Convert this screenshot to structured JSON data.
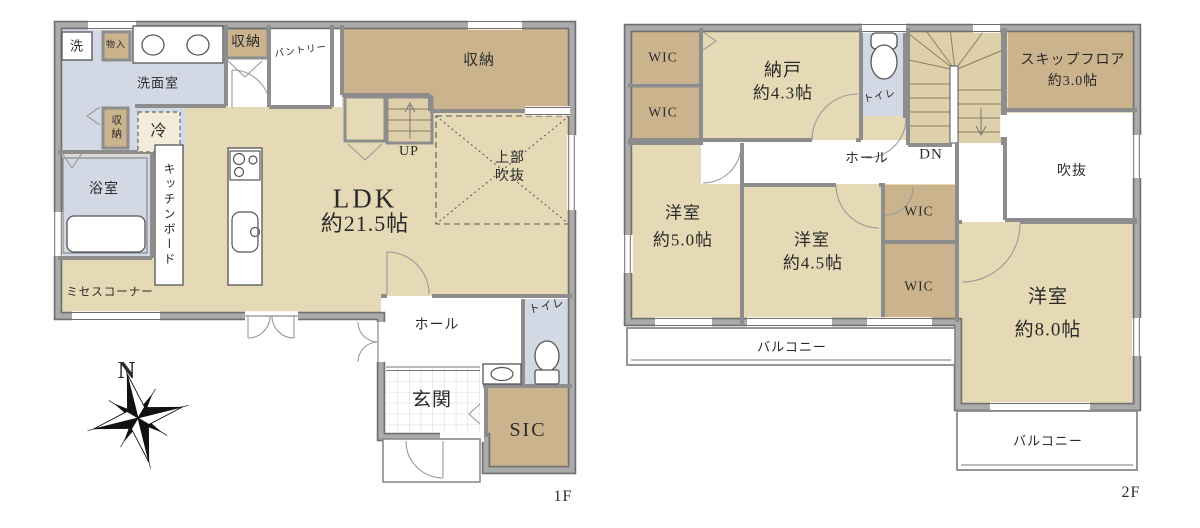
{
  "palette": {
    "floor_tan": "#e6dab6",
    "storage_tan": "#cbb48d",
    "stair_tan": "#ddd0aa",
    "wet_blue": "#d3d9e4",
    "wall_gray": "#a9a9a9",
    "wall_edge": "#6f6f6f",
    "line_dark": "#555555",
    "text": "#2a2a2a",
    "fridge_fill": "#f3ecda",
    "tile_line": "#cccccc"
  },
  "floor1": {
    "floor_label": "1F",
    "labels": {
      "laundry": "洗",
      "small_closet": "物入",
      "washroom": "洗面室",
      "washroom_storage": "収納",
      "storage_cabinet": "収納",
      "pantry": "パントリー",
      "fridge": "冷",
      "bathroom": "浴室",
      "kitchen_board": "キッチンボード",
      "mrs_corner": "ミセスコーナー",
      "ldk_name": "LDK",
      "ldk_size": "約21.5帖",
      "stairs_up": "UP",
      "storage_big": "収納",
      "void_line1": "上部",
      "void_line2": "吹抜",
      "hall": "ホール",
      "toilet": "トイレ",
      "entrance": "玄関",
      "sic": "SIC"
    }
  },
  "floor2": {
    "floor_label": "2F",
    "labels": {
      "wic_nw_upper": "WIC",
      "wic_nw_lower": "WIC",
      "storeroom_name": "納戸",
      "storeroom_size": "約4.3帖",
      "toilet": "トイレ",
      "hall": "ホール",
      "stairs_down": "DN",
      "skip_floor_name": "スキップフロア",
      "skip_floor_size": "約3.0帖",
      "void": "吹抜",
      "bedroom_w_name": "洋室",
      "bedroom_w_size": "約5.0帖",
      "bedroom_c_name": "洋室",
      "bedroom_c_size": "約4.5帖",
      "bedroom_e_name": "洋室",
      "bedroom_e_size": "約8.0帖",
      "wic_e_upper": "WIC",
      "wic_e_lower": "WIC",
      "balcony_west": "バルコニー",
      "balcony_east": "バルコニー"
    }
  },
  "compass": {
    "north_label": "N"
  }
}
